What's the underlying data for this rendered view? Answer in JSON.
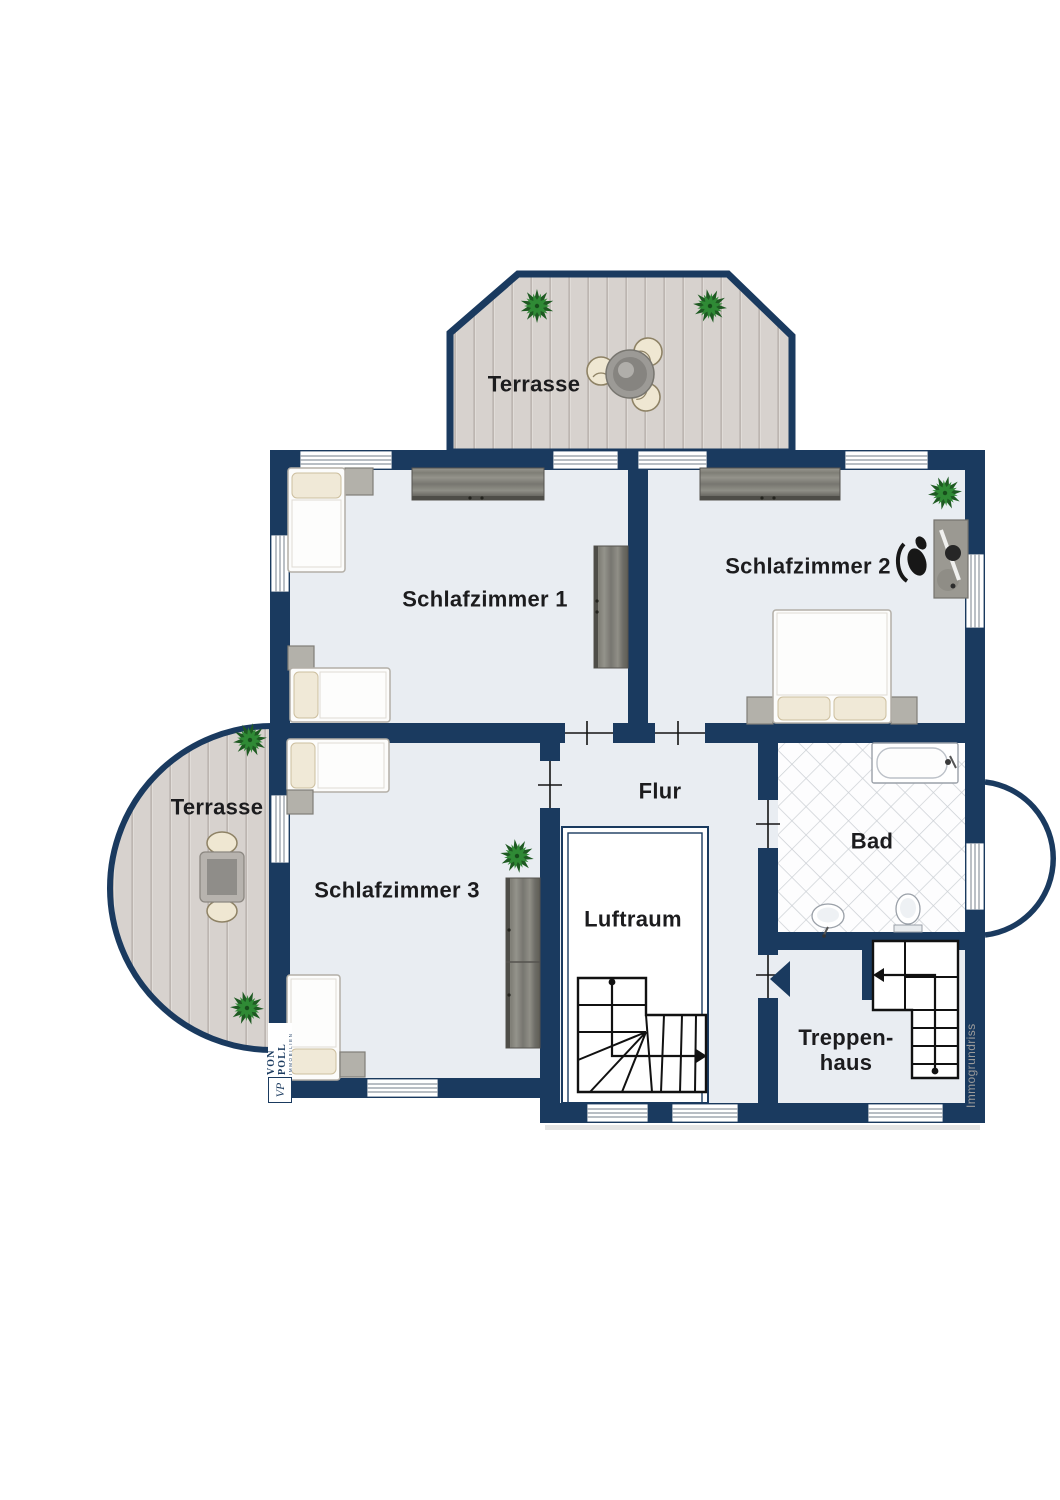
{
  "labels": {
    "terrace_top": "Terrasse",
    "terrace_left": "Terrasse",
    "bedroom1": "Schlafzimmer 1",
    "bedroom2": "Schlafzimmer 2",
    "bedroom3": "Schlafzimmer 3",
    "hallway": "Flur",
    "air_space": "Luftraum",
    "bathroom": "Bad",
    "staircase_line1": "Treppen-",
    "staircase_line2": "haus"
  },
  "branding": {
    "company": "VON POLL",
    "company_sub": "IMMOBILIEN",
    "monogram": "VP",
    "credit": "Immogrundriss"
  },
  "colors": {
    "wall_navy": "#1a3a5f",
    "floor_gray": "#e9edf2",
    "deck_wood": "#d7d2ce",
    "tile_line": "#ccd0d5",
    "furniture_wood": "#8d8d89",
    "plant_green": "#2f8a35",
    "label_text": "#1c1c1e",
    "credit_text": "#9b9b9b"
  }
}
